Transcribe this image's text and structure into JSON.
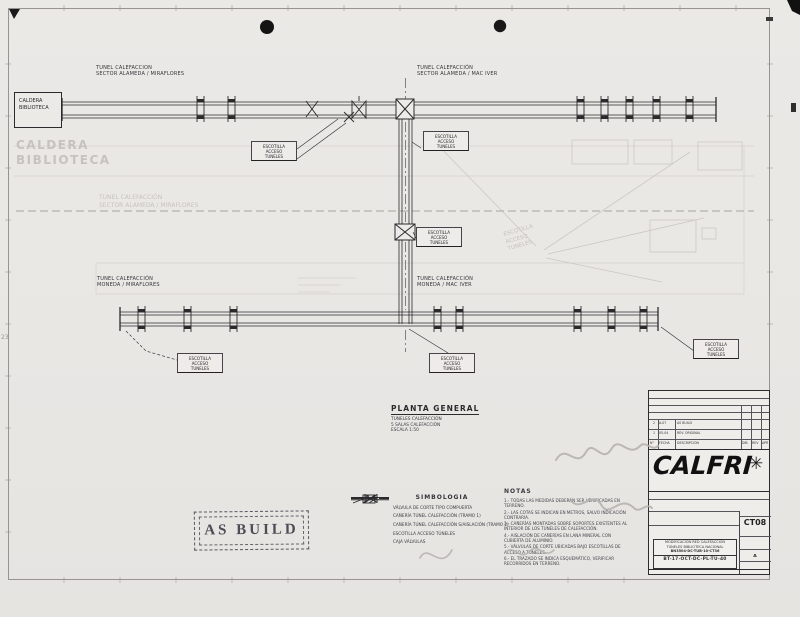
{
  "colors": {
    "paper": "#e9e7e4",
    "ink": "#2b2b2e",
    "ghost": "#c6c3bf",
    "stamp": "#4c4c55"
  },
  "drawing": {
    "caldera_box": {
      "line1": "CALDERA",
      "line2": "BIBLIOTECA"
    },
    "sections": {
      "top_left": {
        "line1": "TUNEL CALEFACCION",
        "line2": "SECTOR ALAMEDA / MIRAFLORES"
      },
      "top_right": {
        "line1": "TUNEL CALEFACCIÓN",
        "line2": "SECTOR ALAMEDA / MAC IVER"
      },
      "bottom_left": {
        "line1": "TUNEL CALEFACCIÓN",
        "line2": "MONEDA / MIRAFLORES"
      },
      "bottom_right": {
        "line1": "TUNEL CALEFACCIÓN",
        "line2": "MONEDA / MAC IVER"
      }
    },
    "hatch_label": {
      "line1": "ESCOTILLA",
      "line2": "ACCESO",
      "line3": "TUNELES"
    },
    "ghost": {
      "sector": {
        "line1": "TUNEL CALEFACCIÓN",
        "line2": "SECTOR ALAMEDA / MIRAFLORES"
      },
      "caldera": {
        "line1": "CALDERA",
        "line2": "BIBLIOTECA"
      },
      "escotilla": {
        "line1": "ESCOTILLA",
        "line2": "ACCESO",
        "line3": "TUNELES"
      }
    },
    "planta": {
      "title": "PLANTA GENERAL",
      "line1": "TUNELES CALEFACCIÓN",
      "line2": "5 SALAS CALEFACCIÓN",
      "line3": "ESCALA 1:50"
    }
  },
  "stamp": {
    "text": "AS BUILD"
  },
  "simbologia": {
    "title": "SIMBOLOGIA",
    "items": [
      {
        "icon": "valve-icon",
        "text": "VÁLVULA DE CORTE TIPO COMPUERTA"
      },
      {
        "icon": "dashed-line-icon",
        "text": "CAÑERÍA TÚNEL CALEFACCIÓN (TRAMO 1)"
      },
      {
        "icon": "solid-line-icon",
        "text": "CAÑERÍA TÚNEL CALEFACCIÓN S/AISLACIÓN (TRAMO 2)"
      },
      {
        "icon": "hatch-icon",
        "text": "ESCOTILLA ACCESO TÚNELES"
      },
      {
        "icon": "none",
        "text": "CAJA VÁLVULAS"
      }
    ]
  },
  "notas": {
    "title": "NOTAS",
    "lines": [
      "1.- TODAS LAS MEDIDAS DEBERÁN SER VERIFICADAS EN TERRENO.",
      "2.- LAS COTAS SE INDICAN EN METROS, SALVO INDICACIÓN CONTRARIA.",
      "3.- CAÑERÍAS MONTADAS SOBRE SOPORTES EXISTENTES AL INTERIOR DE LOS TÚNELES DE CALEFACCIÓN.",
      "4.- AISLACIÓN DE CAÑERÍAS EN LANA MINERAL CON CUBIERTA DE ALUMINIO.",
      "5.- VÁLVULAS DE CORTE UBICADAS BAJO ESCOTILLAS DE ACCESO A TÚNELES.",
      "6.- EL TRAZADO SE INDICA ESQUEMÁTICO, VERIFICAR RECORRIDOS EN TERRENO."
    ]
  },
  "titleblock": {
    "logo": "CALFRI",
    "logo_star_icon": "snowflake-burst-icon",
    "rev_rows": [
      {
        "no": "2",
        "date": "A-07",
        "desc": "AS BUILD"
      },
      {
        "no": "1",
        "date": "05-04",
        "desc": "REV. ORIGINAL"
      }
    ],
    "rev_header": {
      "no": "N°",
      "date": "FECHA",
      "desc": "DESCRIPCIÓN",
      "dib": "DIB",
      "rev": "REV",
      "apr": "APR"
    },
    "sheet_code": "CT08",
    "doc": {
      "line1": "MODIFICACIÓN RED CALEFACCIÓN",
      "line2": "TÚNELES BIBLIOTECA NACIONAL",
      "line3": "BN3504-DC-TUB-10-CT36",
      "code": "BT-17-OCT-DC-PL-TU-40",
      "rev": "A"
    }
  },
  "edge": {
    "left_number": "23"
  }
}
